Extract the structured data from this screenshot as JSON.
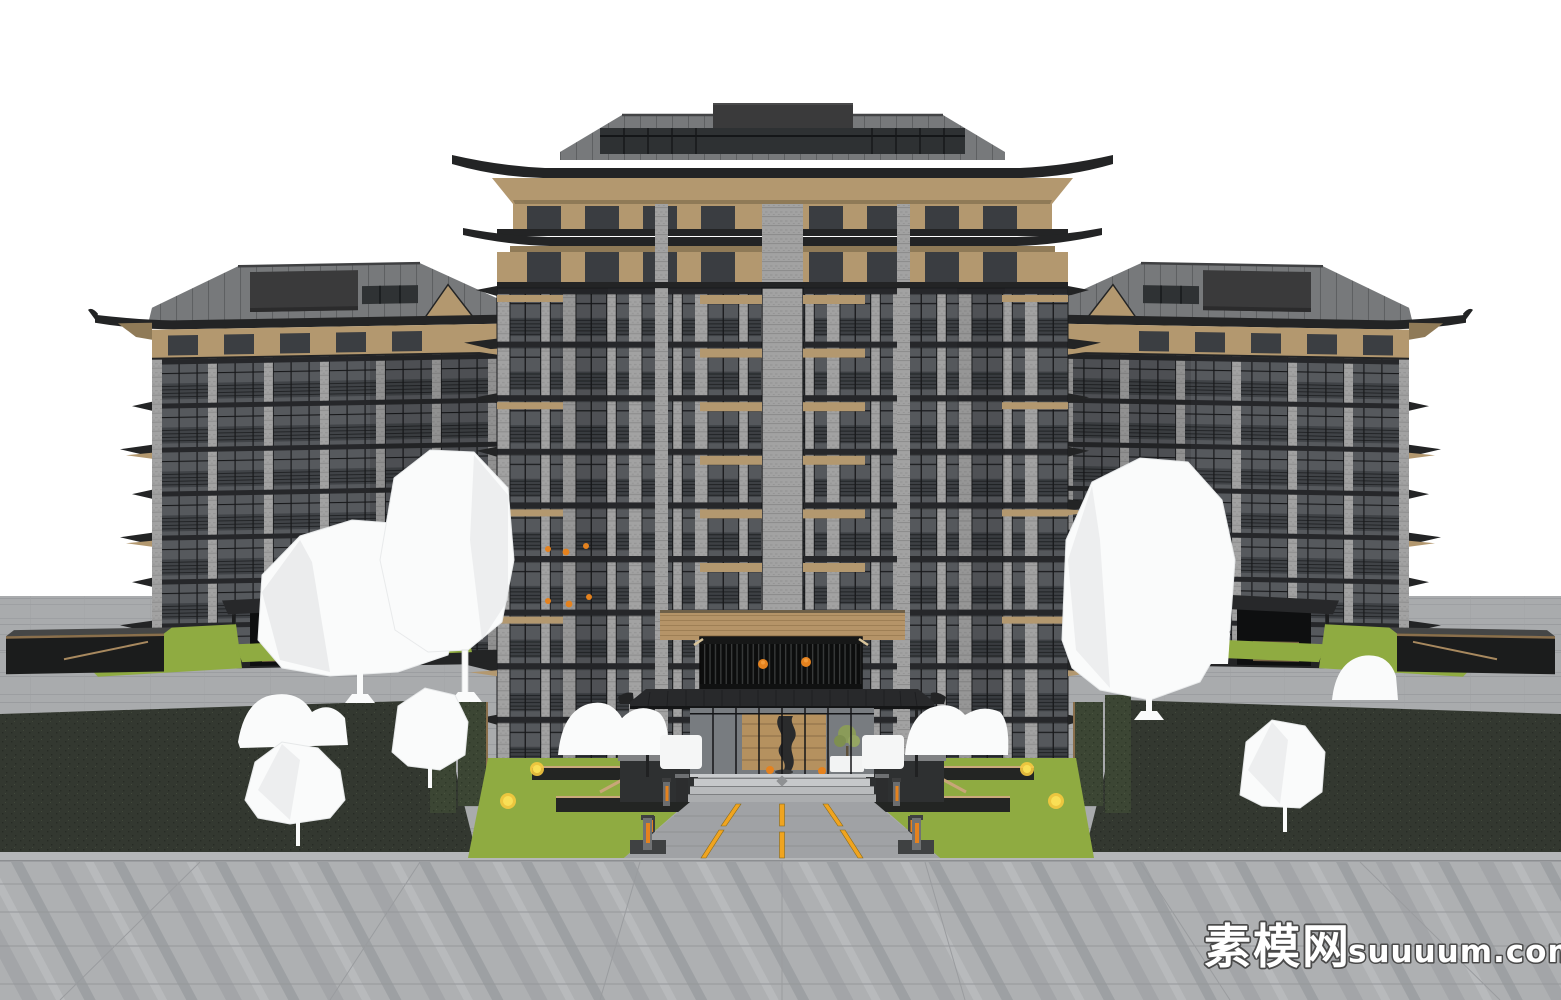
{
  "meta": {
    "type": "3d-architectural-render",
    "subject": "Chinese-style residential apartment complex massing model: one tall central building with upturned hip roofs flanked by two mirrored side buildings, white low-poly trees, landscaped entrance plaza with lawns, hedges, bollards and a slatted entrance pavilion with orange lanterns"
  },
  "watermark": {
    "site_name_cjk": "素模网",
    "site_domain": "suuuum.com"
  },
  "colors": {
    "sky": "#ffffff",
    "roofmetal": "#77797b",
    "roofdark": "#232425",
    "roofbox": "#3a3a3b",
    "tan": "#b3986f",
    "tanshadow": "#8f7a57",
    "deckwood": "#b59468",
    "pier": "#a2a2a2",
    "glass": "#55585c",
    "glasslight": "#787c80",
    "slab": "#26272a",
    "frame": "#141517",
    "lawn": "#8fab41",
    "lawndark": "#333830",
    "hedge": "#3c4634",
    "paving": "#a9abad",
    "plaza": "#aeb0b2",
    "curb": "#b5b7b9",
    "roadline": "#f0a41f",
    "orange": "#e5821e",
    "lanternglow": "#f39b3a",
    "treewhite": "#fafbfb",
    "treeshade": "#e4e6e7",
    "bench": "#232523",
    "wallface": "#2e3031",
    "wallcap": "#808284",
    "wood": "#b5915f",
    "wmfill": "#ffffff",
    "wmstroke": "#4a4a4a"
  }
}
